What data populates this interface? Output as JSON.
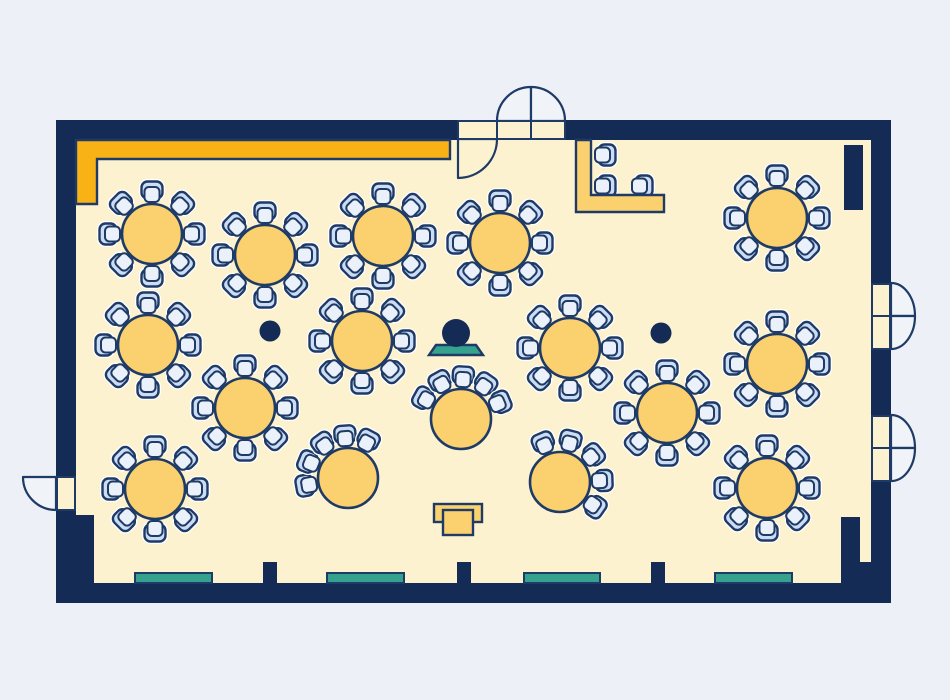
{
  "meta": {
    "diagram_type": "banquet-hall-floor-plan",
    "description": "Top-down event room floor plan: round banquet tables with chairs, crescent tables facing a speaker podium, head table, stage strip, doors and windows"
  },
  "colors": {
    "background": "#edf1f7",
    "wall": "#132b55",
    "outline": "#1e3a66",
    "floor": "#fdf2cf",
    "accent_orange": "#f9b215",
    "table_fill": "#fbd170",
    "chair_back_fill": "#ccdcf2",
    "chair_seat_fill": "#eaf1fb",
    "teal": "#35a28d",
    "door_leaf_fill": "#fdf2cf",
    "outside_door_fill": "#f0f4f9",
    "halo": "#ffffff"
  },
  "canvas": {
    "width": 950,
    "height": 700
  },
  "room": {
    "outer": [
      56,
      120,
      835,
      483
    ],
    "floor": [
      76,
      140,
      795,
      443
    ]
  },
  "stage_strip": {
    "points": [
      [
        76,
        140
      ],
      [
        450,
        140
      ],
      [
        450,
        159
      ],
      [
        97,
        159
      ],
      [
        97,
        204
      ],
      [
        76,
        204
      ]
    ]
  },
  "wall_blocks": [
    {
      "name": "pilaster-top-right",
      "rect": [
        844,
        145,
        19,
        65
      ]
    },
    {
      "name": "corner-block-bottom-left",
      "rect": [
        76,
        515,
        18,
        68
      ]
    },
    {
      "name": "corner-block-bottom-right",
      "rect": [
        841,
        517,
        19,
        66
      ]
    },
    {
      "name": "corner-block-bottom-right-2",
      "rect": [
        860,
        562,
        11,
        21
      ]
    },
    {
      "name": "wall-stub-1",
      "rect": [
        263,
        562,
        14,
        21
      ]
    },
    {
      "name": "wall-stub-2",
      "rect": [
        457,
        562,
        14,
        21
      ]
    },
    {
      "name": "wall-stub-3",
      "rect": [
        651,
        562,
        14,
        21
      ]
    }
  ],
  "windows": [
    [
      135,
      573,
      77,
      10
    ],
    [
      327,
      573,
      77,
      10
    ],
    [
      524,
      573,
      76,
      10
    ],
    [
      715,
      573,
      77,
      10
    ]
  ],
  "columns": {
    "centers": [
      [
        270,
        331
      ],
      [
        661,
        333
      ]
    ],
    "radius": 10.5
  },
  "doors": [
    {
      "name": "door-top-single",
      "panels": [
        [
          458,
          121,
          39,
          18
        ]
      ],
      "pies": [
        {
          "c": [
            458,
            139
          ],
          "rx": 39,
          "ry": 39,
          "a0": 0,
          "a1": 90,
          "fill": "floor"
        }
      ]
    },
    {
      "name": "door-top-double",
      "panels": [
        [
          497,
          121,
          34,
          18
        ],
        [
          531,
          121,
          34,
          18
        ]
      ],
      "pies": [
        {
          "c": [
            531,
            121
          ],
          "rx": 34,
          "ry": 34,
          "a0": 180,
          "a1": 270,
          "fill": "outside"
        },
        {
          "c": [
            531,
            121
          ],
          "rx": 34,
          "ry": 34,
          "a0": 270,
          "a1": 360,
          "fill": "outside"
        }
      ]
    },
    {
      "name": "door-right-upper-double",
      "panels": [
        [
          872,
          284,
          18,
          32
        ],
        [
          872,
          316,
          18,
          33
        ]
      ],
      "pies": [
        {
          "c": [
            891,
            316
          ],
          "rx": 24,
          "ry": 33,
          "a0": 270,
          "a1": 360,
          "fill": "outside"
        },
        {
          "c": [
            891,
            316
          ],
          "rx": 24,
          "ry": 33,
          "a0": 0,
          "a1": 90,
          "fill": "outside"
        }
      ]
    },
    {
      "name": "door-right-lower-double",
      "panels": [
        [
          872,
          416,
          18,
          32
        ],
        [
          872,
          448,
          18,
          33
        ]
      ],
      "pies": [
        {
          "c": [
            891,
            448
          ],
          "rx": 24,
          "ry": 33,
          "a0": 270,
          "a1": 360,
          "fill": "outside"
        },
        {
          "c": [
            891,
            448
          ],
          "rx": 24,
          "ry": 33,
          "a0": 0,
          "a1": 90,
          "fill": "outside"
        }
      ]
    },
    {
      "name": "door-left-single",
      "panels": [
        [
          57,
          477,
          18,
          33
        ]
      ],
      "pies": [
        {
          "c": [
            56,
            477
          ],
          "rx": 33,
          "ry": 33,
          "a0": 90,
          "a1": 180,
          "fill": "outside"
        }
      ]
    }
  ],
  "tables": {
    "radius": 30,
    "chair_ring_radius": 43,
    "full_angles": [
      -90,
      -45,
      0,
      45,
      90,
      135,
      180,
      -135
    ],
    "round": [
      [
        152,
        234
      ],
      [
        265,
        255
      ],
      [
        383,
        236
      ],
      [
        500,
        243
      ],
      [
        777,
        218
      ],
      [
        148,
        345
      ],
      [
        362,
        341
      ],
      [
        570,
        348
      ],
      [
        777,
        364
      ],
      [
        245,
        408
      ],
      [
        667,
        413
      ],
      [
        155,
        489
      ],
      [
        767,
        488
      ]
    ],
    "crescent": [
      {
        "center": [
          348,
          478
        ],
        "angles": [
          -190,
          -158,
          -126,
          -94,
          -62
        ]
      },
      {
        "center": [
          461,
          419
        ],
        "angles": [
          -151,
          -119,
          -87,
          -55,
          -23
        ]
      },
      {
        "center": [
          560,
          482
        ],
        "angles": [
          -113,
          -76,
          -39,
          -2,
          35
        ]
      }
    ]
  },
  "head_table": {
    "points": [
      [
        576,
        140
      ],
      [
        591,
        140
      ],
      [
        591,
        195
      ],
      [
        664,
        195
      ],
      [
        664,
        212
      ],
      [
        576,
        212
      ]
    ],
    "chairs": [
      {
        "x": 606,
        "y": 155,
        "rot": 90
      },
      {
        "x": 606,
        "y": 186,
        "rot": 90
      },
      {
        "x": 643,
        "y": 186,
        "rot": 90
      }
    ]
  },
  "speaker": {
    "head": [
      456,
      333
    ],
    "head_radius": 14,
    "podium_points": [
      [
        429,
        355
      ],
      [
        483,
        355
      ],
      [
        476,
        345
      ],
      [
        436,
        345
      ]
    ]
  },
  "service_table": {
    "back": [
      434,
      504,
      48,
      18
    ],
    "front": [
      443,
      510,
      30,
      25
    ]
  }
}
